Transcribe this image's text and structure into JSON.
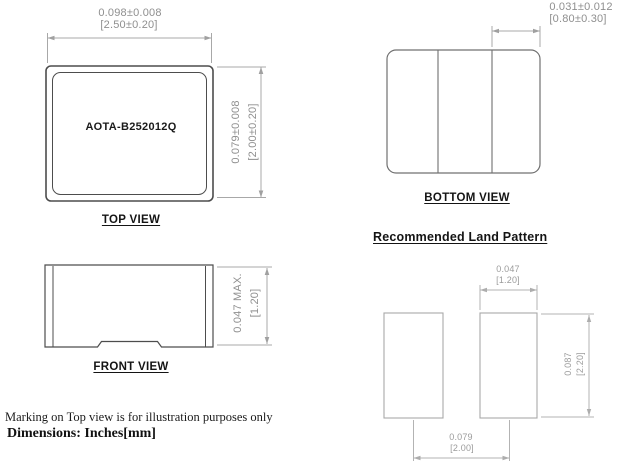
{
  "meta": {
    "drawing_type": "component-dimension-drawing"
  },
  "colors": {
    "background": "#ffffff",
    "object_line": "#4d4d4d",
    "secondary_line": "#707070",
    "pad_line": "#a8a8a8",
    "dim_line": "#a8a8a8",
    "dim_text": "#8f8f8f",
    "label_text": "#141414"
  },
  "top_view": {
    "caption": "TOP VIEW",
    "marking": "AOTA-B252012Q",
    "width_dim_in": "0.098±0.008",
    "width_dim_mm": "[2.50±0.20]",
    "height_dim_in": "0.079±0.008",
    "height_dim_mm": "[2.00±0.20]"
  },
  "bottom_view": {
    "caption": "BOTTOM VIEW",
    "terminal_dim_in": "0.031±0.012",
    "terminal_dim_mm": "[0.80±0.30]"
  },
  "front_view": {
    "caption": "FRONT VIEW",
    "height_dim_in": "0.047 MAX.",
    "height_dim_mm": "[1.20]"
  },
  "land_pattern": {
    "heading": "Recommended Land Pattern",
    "pad_width_in": "0.047",
    "pad_width_mm": "[1.20]",
    "pad_height_in": "0.087",
    "pad_height_mm": "[2.20]",
    "pitch_in": "0.079",
    "pitch_mm": "[2.00]"
  },
  "notes": {
    "marking_note": "Marking on Top view is for illustration purposes only",
    "units_note": "Dimensions: Inches[mm]"
  }
}
